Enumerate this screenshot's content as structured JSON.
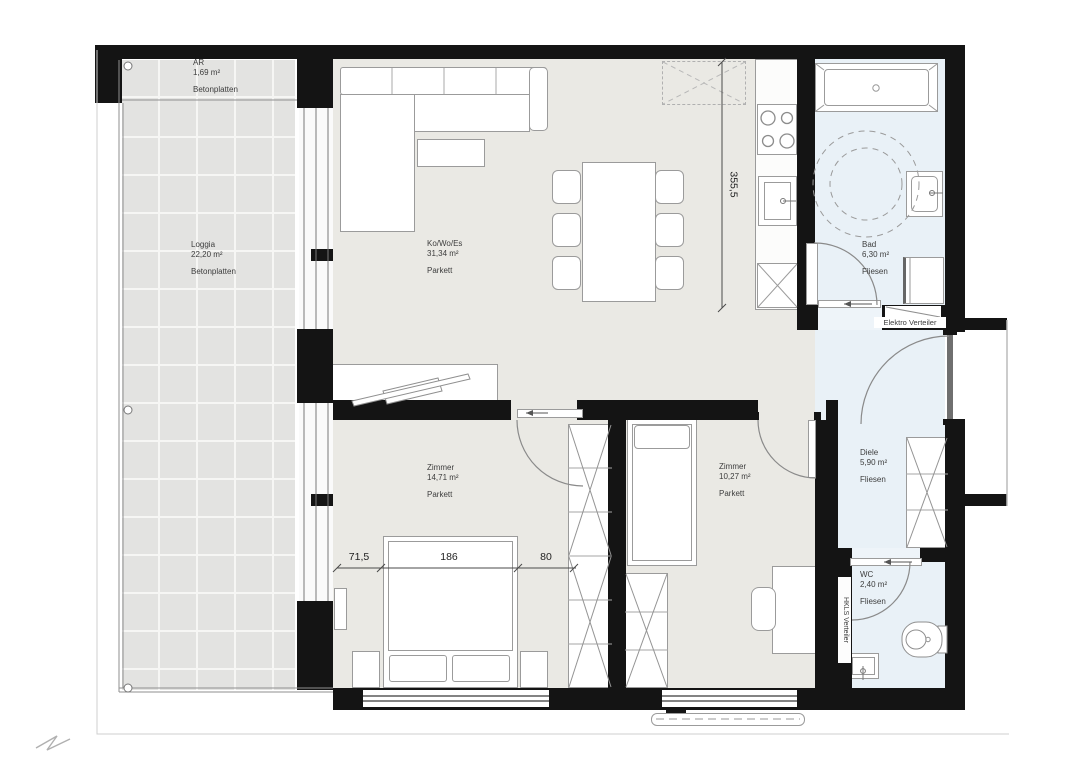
{
  "plan": {
    "rooms": [
      {
        "name": "AR",
        "area": "1,69 m²",
        "floor": "Betonplatten"
      },
      {
        "name": "Loggia",
        "area": "22,20 m²",
        "floor": "Betonplatten"
      },
      {
        "name": "Ko/Wo/Es",
        "area": "31,34 m²",
        "floor": "Parkett"
      },
      {
        "name": "Bad",
        "area": "6,30 m²",
        "floor": "Fliesen"
      },
      {
        "name": "Diele",
        "area": "5,90 m²",
        "floor": "Fliesen"
      },
      {
        "name": "WC",
        "area": "2,40 m²",
        "floor": "Fliesen"
      },
      {
        "name": "Zimmer",
        "area": "14,71 m²",
        "floor": "Parkett"
      },
      {
        "name": "Zimmer",
        "area": "10,27 m²",
        "floor": "Parkett"
      }
    ],
    "annotations": {
      "elektro": "Elektro Verteiler",
      "hkls": "HKLS Verteiler"
    },
    "dimensions": {
      "living_depth": "355,5",
      "bed_offset_left": "71,5",
      "bed_width": "186",
      "bed_offset_right": "80"
    },
    "colors": {
      "wall": "#141414",
      "parquet_floor": "#eae9e4",
      "tile_floor": "#e9f1f7",
      "loggia_floor": "#e3e3e1",
      "furniture_stroke": "#9b9b9b"
    }
  }
}
